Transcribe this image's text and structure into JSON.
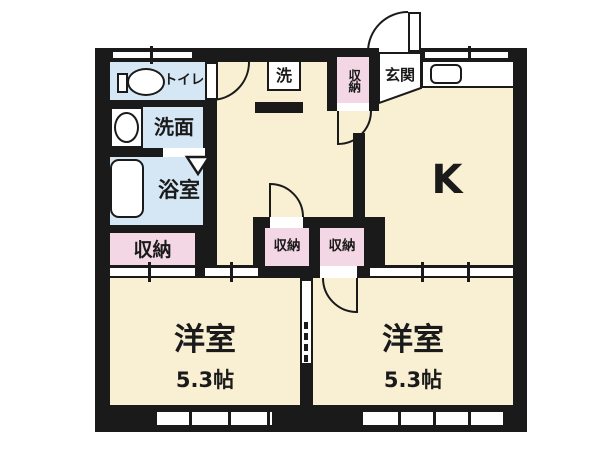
{
  "floorplan": {
    "type": "japanese-apartment-floorplan",
    "rooms": {
      "kitchen": {
        "label": "K"
      },
      "toilet": {
        "label": "トイレ"
      },
      "washroom": {
        "label": "洗面"
      },
      "bathroom": {
        "label": "浴室"
      },
      "laundry": {
        "label": "洗"
      },
      "entrance": {
        "label": "玄関"
      },
      "storage_hall": {
        "label": "収納"
      },
      "storage_entrance": {
        "label": "収納"
      },
      "storage_mid_left": {
        "label": "収納"
      },
      "storage_mid_right": {
        "label": "収納"
      },
      "western_room_left": {
        "label": "洋室",
        "size": "5.3帖"
      },
      "western_room_right": {
        "label": "洋室",
        "size": "5.3帖"
      }
    },
    "colors": {
      "wall": "#1a1a1a",
      "room_floor": "#f9efd3",
      "wet_area": "#d5e7f4",
      "storage": "#f4d7e4",
      "fixture": "#ffffff"
    }
  }
}
